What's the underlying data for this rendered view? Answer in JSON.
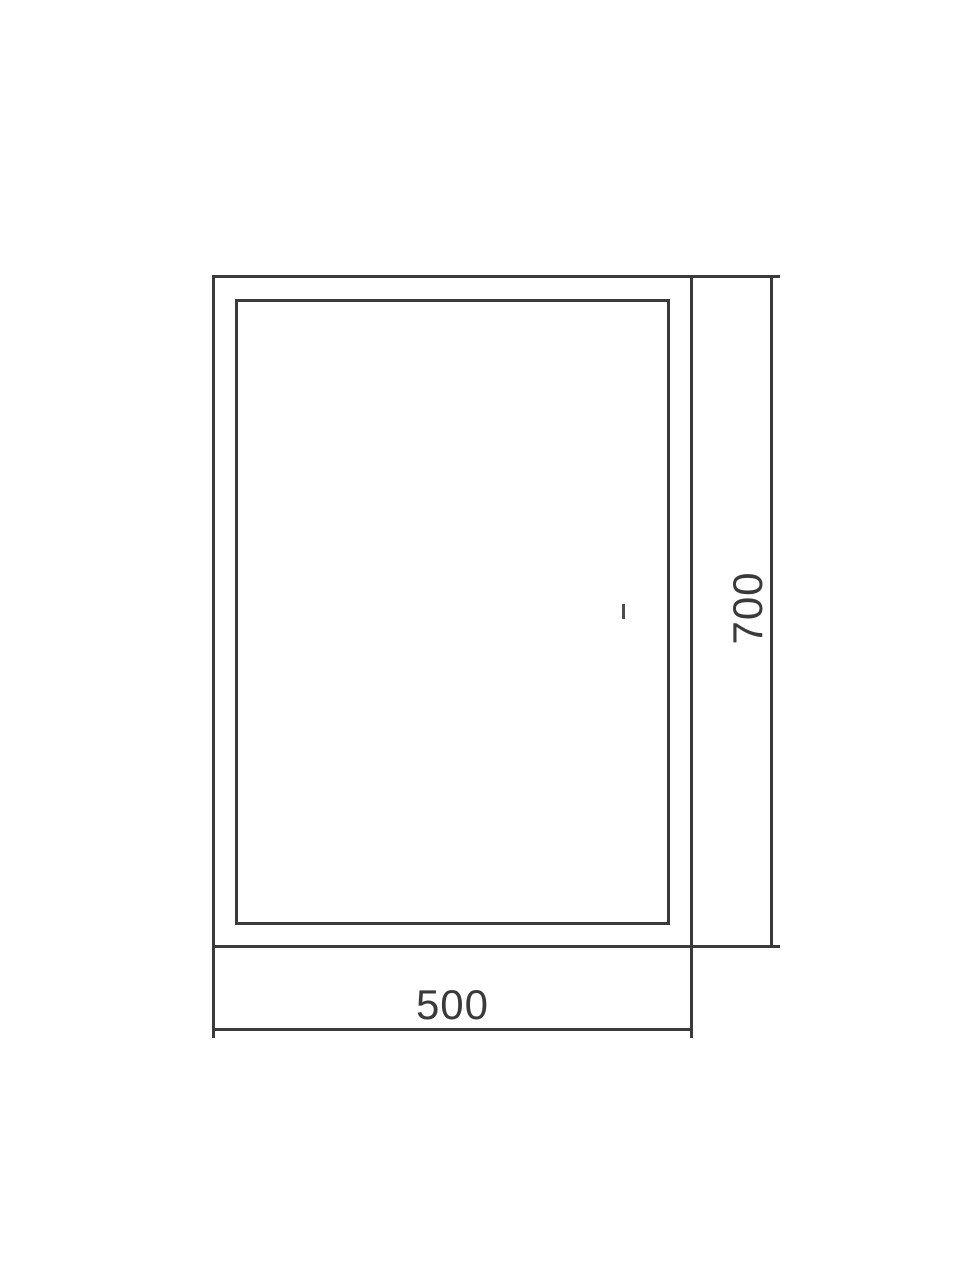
{
  "drawing": {
    "dimensions": {
      "width": {
        "value": "500"
      },
      "height": {
        "value": "700"
      }
    },
    "colors": {
      "line": "#3a3a3a",
      "text": "#3a3a3a",
      "background": "#ffffff"
    },
    "icons": {
      "sensor_tick": "short-vertical-dash"
    }
  }
}
